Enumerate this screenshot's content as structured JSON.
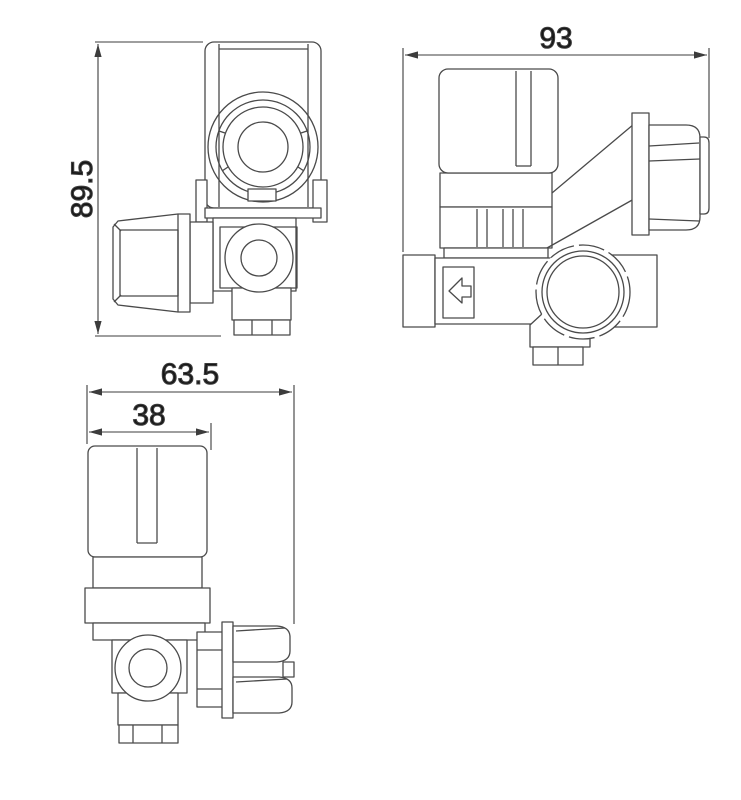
{
  "drawing": {
    "background_color": "#ffffff",
    "line_color": "#4a4a4a",
    "text_color": "#161616",
    "views": {
      "top_view": {
        "label_height": "89.5"
      },
      "side_view": {
        "label_width": "93",
        "flow_arrow": "arrow-left"
      },
      "front_view": {
        "label_overall_width": "63.5",
        "label_cap_width": "38"
      }
    }
  }
}
